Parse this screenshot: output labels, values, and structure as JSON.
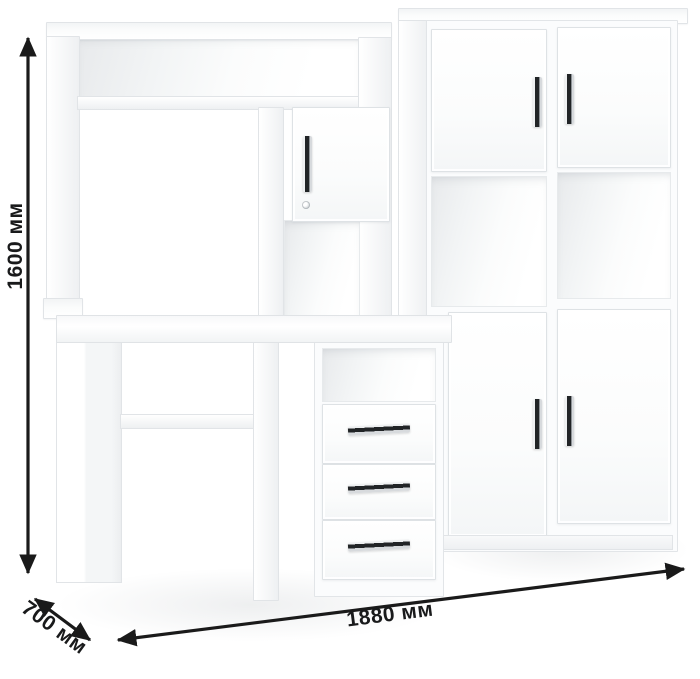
{
  "annotations": {
    "height_label": "1600 мм",
    "depth_label": "700 мм",
    "width_label": "1880 мм"
  },
  "colors": {
    "annotation": "#1a1a1a",
    "furniture_body": "#ffffff",
    "edge_line": "#e3e6e9",
    "handle_dark": "#212426"
  }
}
